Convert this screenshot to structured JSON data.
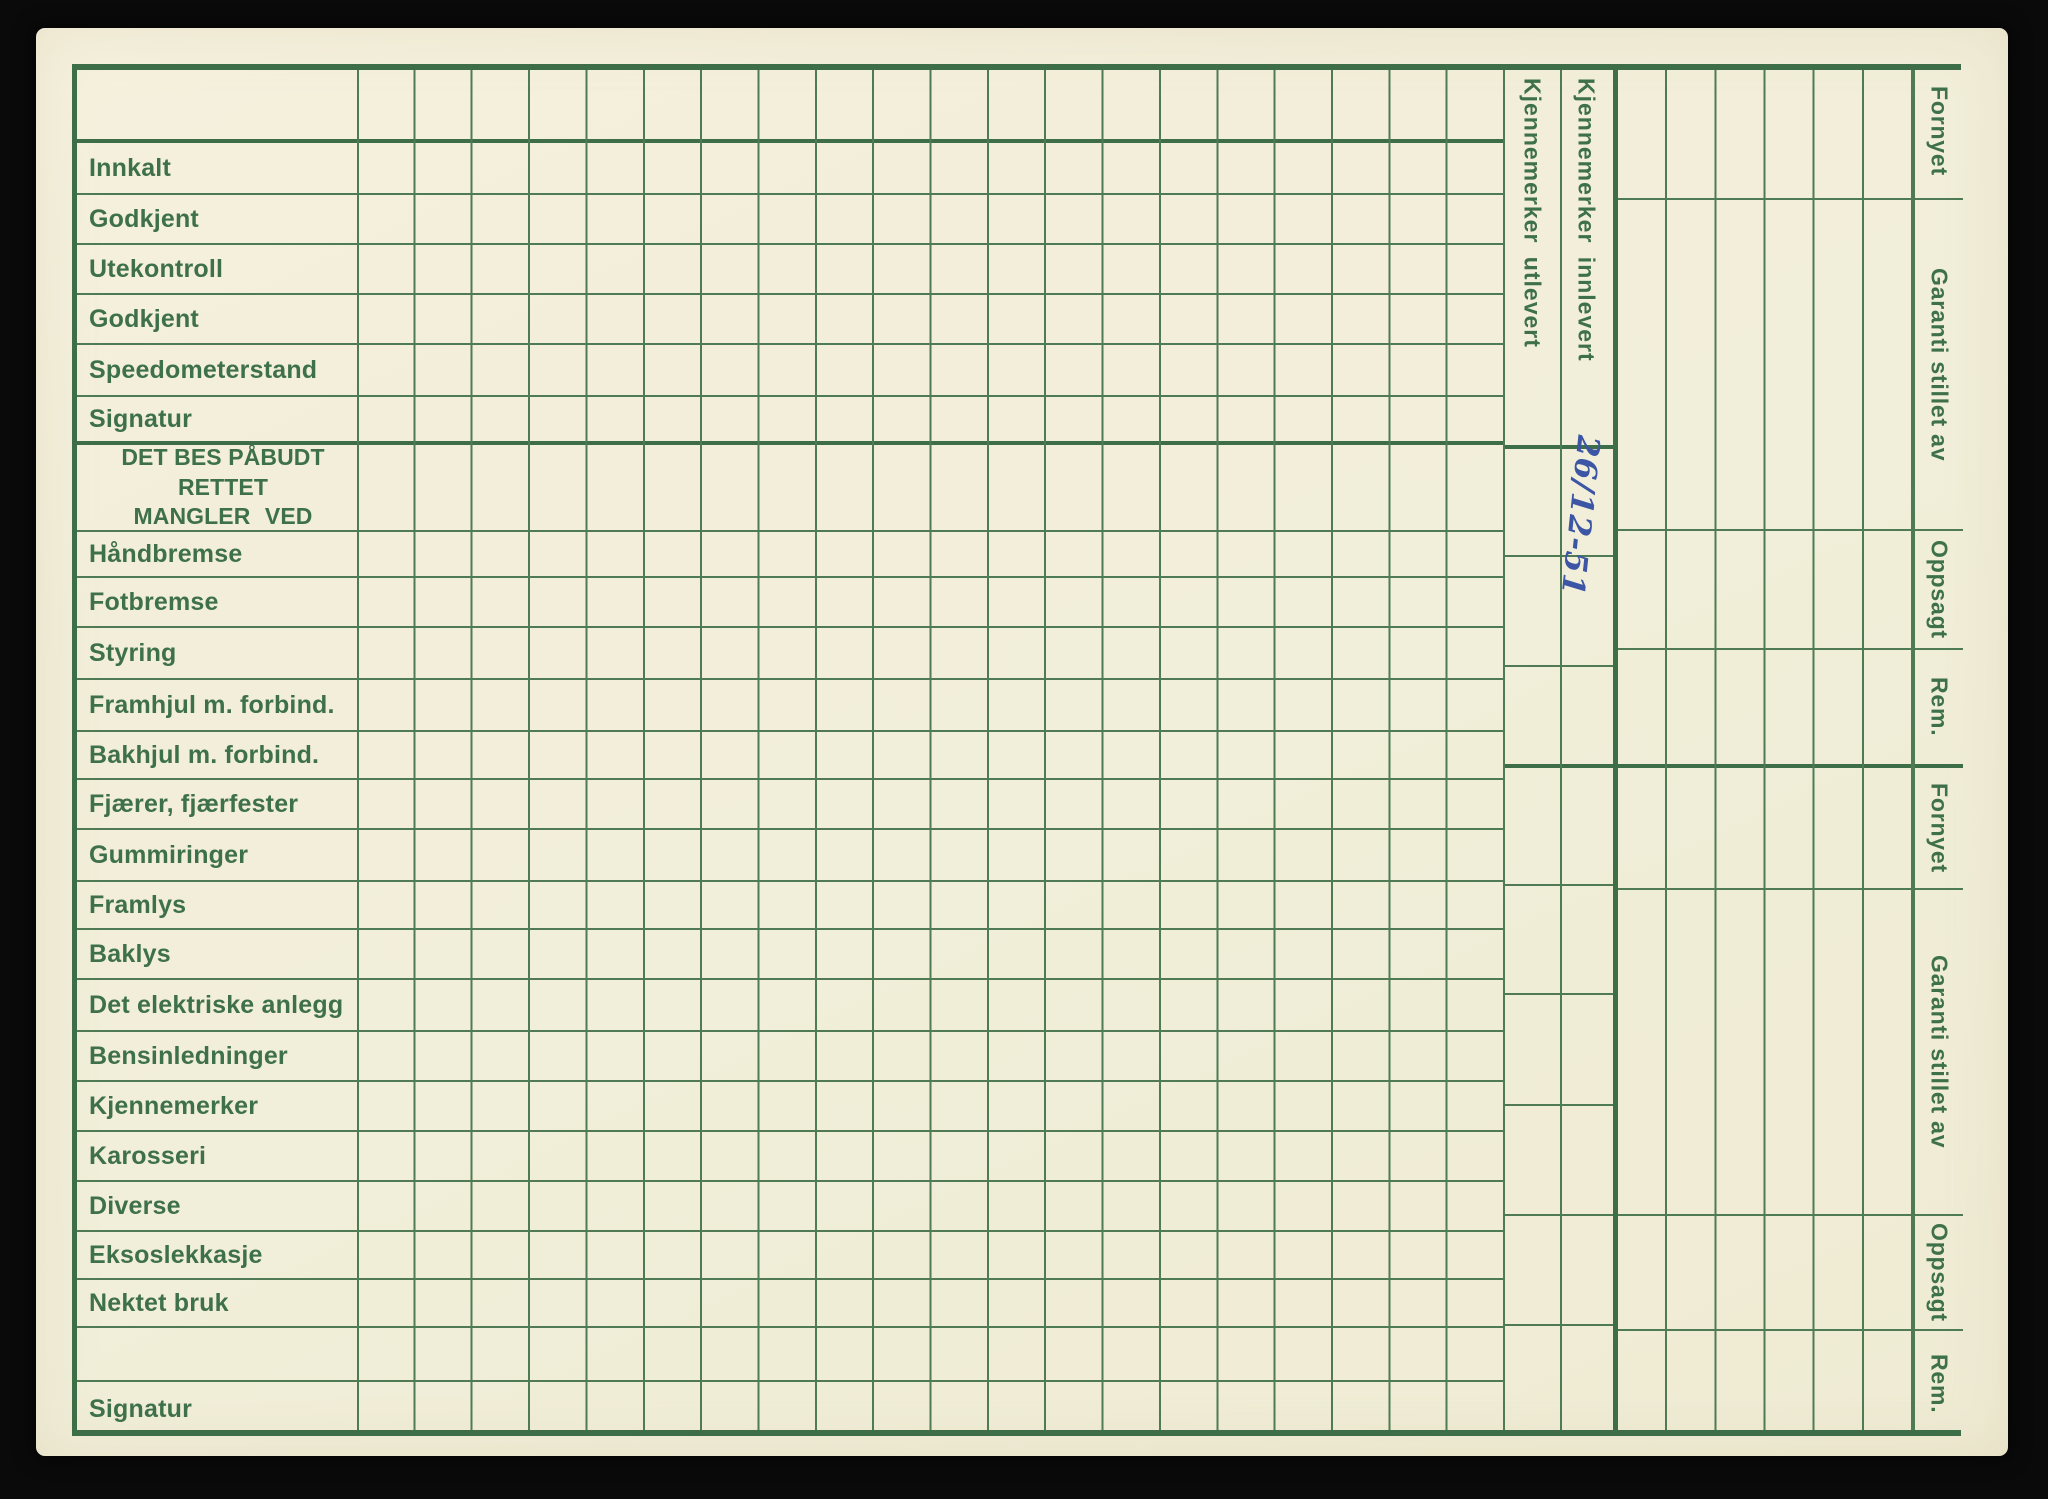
{
  "colors": {
    "bg": "#0a0a0a",
    "paper": "#f2eed9",
    "paper2": "#f6f1de",
    "line": "#4e7b54",
    "line2": "#3e6e48",
    "text": "#3e7149",
    "ink": "#3c55a5"
  },
  "left_rows": [
    {
      "label": "Innkalt"
    },
    {
      "label": "Godkjent"
    },
    {
      "label": "Utekontroll"
    },
    {
      "label": "Godkjent"
    },
    {
      "label": "Speedometerstand"
    },
    {
      "label": "Signatur"
    },
    {
      "label": "DET BES PÅBUDT RETTET",
      "label2": "MANGLER VED"
    },
    {
      "label": "Håndbremse"
    },
    {
      "label": "Fotbremse"
    },
    {
      "label": "Styring"
    },
    {
      "label": "Framhjul m. forbind."
    },
    {
      "label": "Bakhjul m. forbind."
    },
    {
      "label": "Fjærer, fjærfester"
    },
    {
      "label": "Gummiringer"
    },
    {
      "label": "Framlys"
    },
    {
      "label": "Baklys"
    },
    {
      "label": "Det elektriske anlegg"
    },
    {
      "label": "Bensinledninger"
    },
    {
      "label": "Kjennemerker"
    },
    {
      "label": "Karosseri"
    },
    {
      "label": "Diverse"
    },
    {
      "label": "Eksoslekkasje"
    },
    {
      "label": "Nektet bruk"
    },
    {
      "label": ""
    },
    {
      "label": "Signatur"
    }
  ],
  "kjennemerker_columns": [
    {
      "label": "Kjennemerker utlevert"
    },
    {
      "label": "Kjennemerker innlevert"
    }
  ],
  "right_sections": [
    {
      "label": "Fornyet"
    },
    {
      "label": "Garanti stillet av"
    },
    {
      "label": "Oppsagt"
    },
    {
      "label": "Rem."
    },
    {
      "label": "Fornyet"
    },
    {
      "label": "Garanti stillet av"
    },
    {
      "label": "Oppsagt"
    },
    {
      "label": "Rem."
    }
  ],
  "handwriting": {
    "text": "26/12-51"
  }
}
